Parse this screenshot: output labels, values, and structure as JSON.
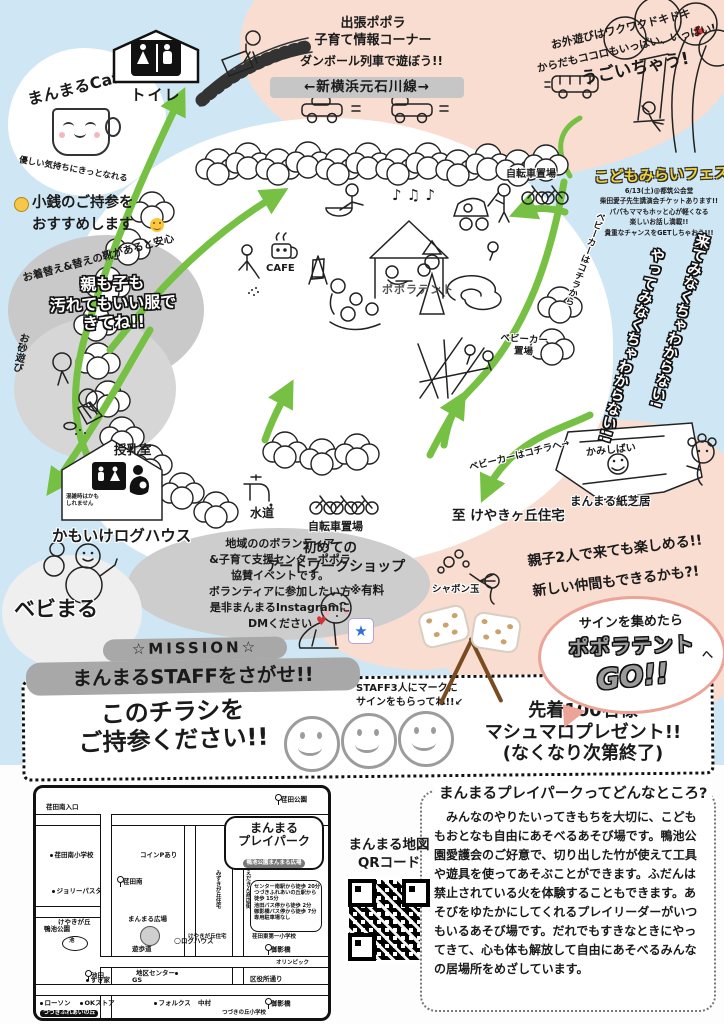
{
  "colors": {
    "bg_blue": "#cfe7f4",
    "blob_pink": "#f8ddd0",
    "path_green": "#76c043",
    "band_gray": "#c6c6c6",
    "mission_gray": "#a8a8a8",
    "salmon": "#eba497",
    "heart_red": "#d13438"
  },
  "header": {
    "cafe_badge": {
      "title": "まんまるCafe",
      "caption": "優しい気持ちにきっとなれる"
    },
    "toilet_label": "トイレ",
    "popola_corner": "出張ポポラ\n子育て情報コーナー",
    "train_note": "ダンボール列車で遊ぼう!!",
    "road_label": "←新横浜元石川線→",
    "tree_lines": [
      "お外遊びはワクワクドキドキ",
      "からだもココロもいっぱい、いっぱい!",
      "うごいちゃう!"
    ],
    "heart": "♥"
  },
  "fes": {
    "title": "こどもみらいフェス",
    "lines": [
      "6/13(土)@都筑公会堂",
      "柴田愛子先生講演会チケットあります!!",
      "パパもママもホッと心が軽くなる",
      "楽しいお話し満載!!",
      "貴重なチャンスをGETしちゃおう!!!"
    ]
  },
  "mystery": [
    "来てみなくちゃわからない!",
    "やってみなくちゃわからない!!"
  ],
  "left_notes": {
    "coins": "小銭のご持参を\nおすすめします",
    "clothes_arc": "お着替え&替えの靴があると安心",
    "clothes_main": "親も子も\n汚れてもいい服で\nきてね!!",
    "sand": "お砂遊び"
  },
  "park_map": {
    "cafe": "CAFE",
    "tent": "ポポラテント",
    "music": "♪ ♫ ♪",
    "bike_top": "自転車置場",
    "stroller_park": "ベビーカー\n置場",
    "stroller_from": "ベビーカーはコチラから",
    "stroller_to": "ベビーカーはコチラへ→",
    "nursing": "授乳室",
    "nursing_note": "混雑時はかも\nしれません",
    "loghouse": "かもいけログハウス",
    "water": "水道",
    "bike_bottom": "自転車置場",
    "to_keyaki": "至 けやきヶ丘住宅",
    "kamishibai_stage": "かみしばい",
    "kamishibai_label": "まんまる紙芝居"
  },
  "mid": {
    "volunteer": "地域ののボランティア\n&子育て支援センターポポラ\n協賛イベントです。\nボランティアに参加したい方\n是非まんまるInstagramに\nDMください",
    "bebimaru": "ベビまる",
    "art1": "初めての",
    "art2": "アートワークショップ",
    "art_fee": "※有料",
    "bubbles": "シャボン玉",
    "enjoy1": "親子2人で来ても楽しめる!!",
    "enjoy2": "新しい仲間もできるかも?!",
    "star": "★"
  },
  "go_bubble": {
    "line1": "サインを集めたら",
    "line2": "ポポラテント",
    "to": "へ",
    "line3": "GO!!"
  },
  "mission": {
    "title": "☆MISSION☆",
    "subtitle": "まんまるSTAFFをさがせ!!",
    "staff_note": "STAFF3人にマークに\nサインをもらってね!!↙",
    "flyer": "このチラシを\nご持参ください!!",
    "prize": "先着100名様\nマシュマロプレゼント!!\n(なくなり次第終了)"
  },
  "street_map": {
    "labels": [
      "荏田南入口",
      "荏田公園",
      "みずきが丘住宅",
      "えだきん商店街",
      "荏田南小学校",
      "荏田南",
      "コインPあり",
      "ジョリーパスタ",
      "けやきが丘",
      "荏田東第一小学校",
      "けやきが丘住宅",
      "まんまる広場",
      "ログハウス",
      "鴨池公園",
      "池",
      "遊歩道",
      "池田",
      "すき家",
      "地区センター",
      "GS",
      "区役所通り",
      "ローソン",
      "OKストア",
      "フォルクス",
      "御影橋",
      "御影橋",
      "つづきふれあいの丘",
      "中村",
      "オリンピック",
      "つづきの丘小学校"
    ],
    "bubble": {
      "line1": "まんまる",
      "line2": "プレイパーク",
      "sub": "鴨池公園まんまる広場"
    },
    "access": [
      "センター南駅から徒歩 20分",
      "つづきふれあいの丘駅から 徒歩 15分",
      "池田バス停から徒歩 2分",
      "御影橋バス停から徒歩 7分",
      "専用駐車場なし"
    ]
  },
  "qr": {
    "label": "まんまる地図\nQRコード"
  },
  "about": {
    "title": "まんまるプレイパークってどんなところ?",
    "body": "みんなのやりたいってきもちを大切に、こどももおとなも自由にあそべるあそび場です。鴨池公園愛護会のご好意で、切り出した竹が使えて工具や遊具を使ってあそぶことができます。ふだんは禁止されている火を体験することもできます。あそびをゆたかにしてくれるプレイリーダーがいつもいるあそび場です。だれでもすきなときにやってきて、心も体も解放して自由にあそべるみんなの居場所をめざしています。"
  }
}
